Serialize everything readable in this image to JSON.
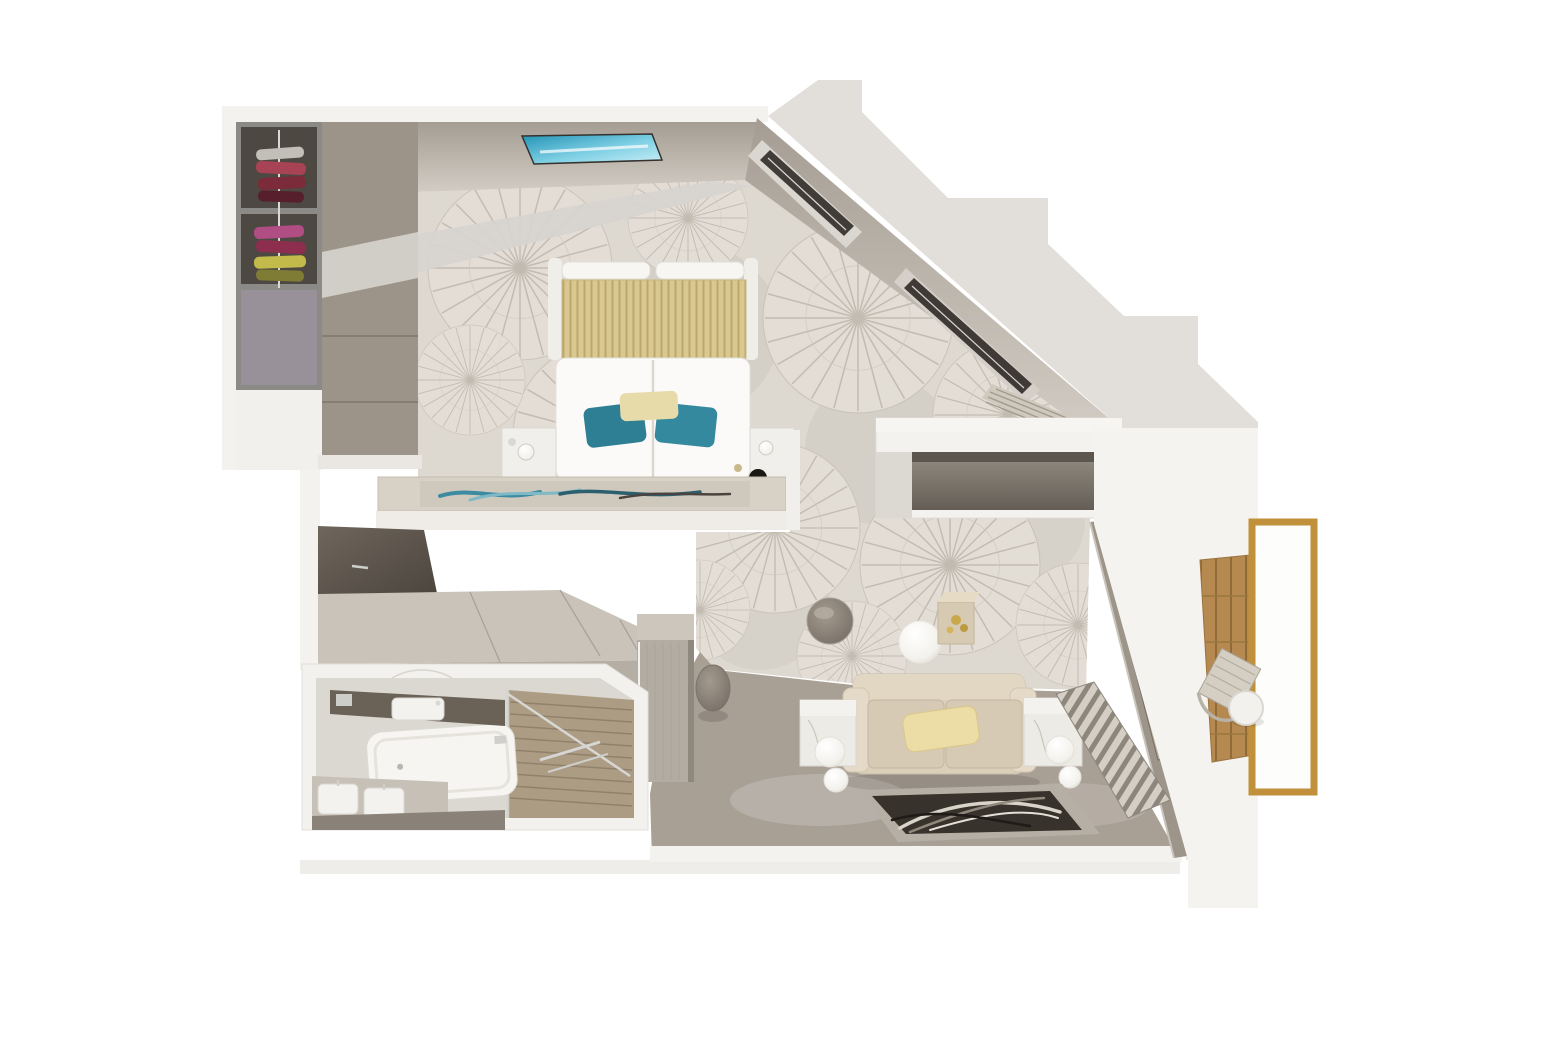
{
  "scene": {
    "type": "3d-floor-plan-top-view",
    "subject": "suite floor plan rendering",
    "rooms": [
      {
        "id": "bedroom",
        "label": "Bedroom",
        "furniture": [
          "open-wardrobe-shelves",
          "closet-sliding-doors",
          "double-bed",
          "gold-striped-headboard-throw",
          "teal-accent-pillows",
          "beige-accent-pillow",
          "nightstands",
          "foot-of-bed-console-with-art-runner",
          "ceiling-skylight-panel",
          "angled-wall-slit-windows",
          "sunburst-pattern-carpet"
        ]
      },
      {
        "id": "dressing-corridor",
        "label": "Dressing corridor",
        "furniture": [
          "dark-mirror-panel",
          "vanity-desk-top",
          "tall-cabinet",
          "round-stool"
        ]
      },
      {
        "id": "bathroom",
        "label": "Bathroom",
        "furniture": [
          "bathtub",
          "vanity-counter-with-sink",
          "double-sink-cabinet",
          "walk-in-shower",
          "glass-partition",
          "teak-shower-floor"
        ]
      },
      {
        "id": "living-area",
        "label": "Living area",
        "furniture": [
          "two-seat-sofa",
          "yellow-throw-pillow",
          "marble-cube-side-tables",
          "globe-floor-lamps",
          "leaf-pattern-rug",
          "round-side-table",
          "cube-decor-table-with-gold-flowers",
          "sphere-lamp",
          "tv-console-alcove",
          "folded-curtain-stack",
          "radiator-slat-bench",
          "window-wall"
        ]
      },
      {
        "id": "balcony",
        "label": "Balcony",
        "furniture": [
          "teak-deck",
          "woven-lounge-chair",
          "round-cocktail-table",
          "gold-framed-glass-balustrade"
        ]
      }
    ]
  },
  "palette": {
    "page_bg": "#ffffff",
    "exterior_grey": "#e2dfdb",
    "exterior_grey_light": "#e9e7e3",
    "wall_white": "#f4f2ef",
    "wall_band": "#b3aba1",
    "carpet": "#ddd8d0",
    "floor": "#a89f95",
    "closet_interior": "#4e4842",
    "closet_doors": "#9d9489",
    "desk_top": "#c9c3ba",
    "cabinet": "#b3aca2",
    "bed_white": "#fbfaf8",
    "headboard_gold": "#d9c88f",
    "pillow_teal": "#2e7e94",
    "pillow_gold": "#ecdda6",
    "bench": "#d8d1c6",
    "sofa": "#dbcfba",
    "marble": "#edebe6",
    "rug_field": "#37322b",
    "rug_border": "#b5afa5",
    "balcony_slab": "#f5f3f0",
    "balcony_wood": "#b5894f",
    "gold_frame": "#c1903a",
    "bathroom_floor": "#dbd7d1",
    "shower_wood": "#ad9c84",
    "counter_dark": "#6a6157",
    "skylight_teal": "#2fa9c7",
    "chrome": "#d6d6d3",
    "art_teal": "#3c8ba0"
  }
}
